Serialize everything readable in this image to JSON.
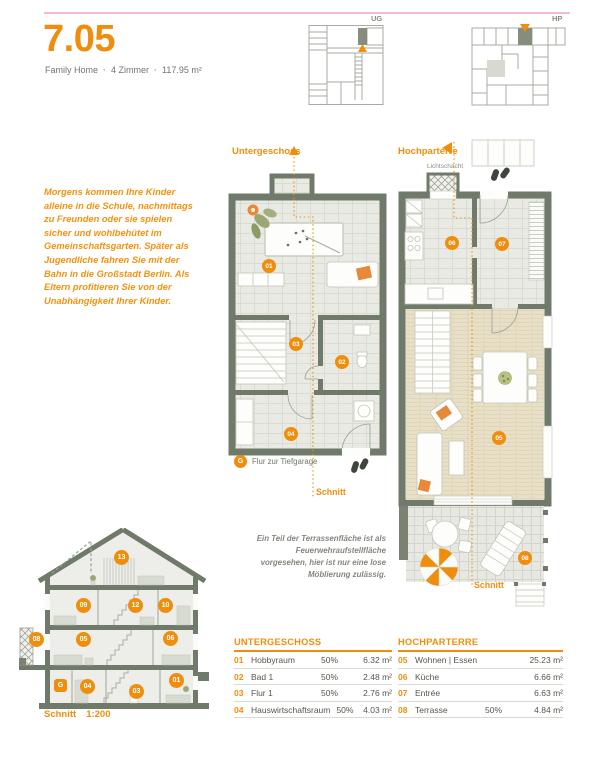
{
  "colors": {
    "accent_orange": "#ef8e0d",
    "wall_green_gray": "#6f7a6a",
    "pink_rule": "#f7b9d2",
    "cushion_orange": "#e8883a"
  },
  "header": {
    "title": "7.05",
    "subtitle": {
      "type": "Family Home",
      "rooms": "4 Zimmer",
      "area": "117.95 m²",
      "separator": "·"
    }
  },
  "key_plans": {
    "ug_label": "UG",
    "hp_label": "HP"
  },
  "intro_text": "Morgens kommen Ihre Kinder alleine in die Schule, nachmittags zu Freunden oder sie spielen sicher und wohlbehütet im Gemeinschaftsgarten. Später als Jugendliche fahren Sie mit der Bahn in die Großstadt Berlin. Als Eltern profitieren Sie von der Unabhängigkeit Ihrer Kinder.",
  "plan_ug": {
    "label": "Untergeschoss",
    "section_label": "Schnitt",
    "markers": {
      "m01": "01",
      "m02": "02",
      "m03": "03",
      "m04": "04"
    },
    "footnote": {
      "marker": "G",
      "text": "Flur zur Tiefgarage"
    }
  },
  "plan_hp": {
    "label": "Hochparterre",
    "lichtschacht": "Lichtschacht",
    "section_label": "Schnitt",
    "markers": {
      "m05": "05",
      "m06": "06",
      "m07": "07",
      "m08": "08"
    }
  },
  "terrace_note": "Ein Teil der Terrassenfläche ist als Feuerwehraufstellfläche vorgesehen, hier ist nur eine lose Möblierung zulässig.",
  "section_view": {
    "caption_label": "Schnitt",
    "caption_scale": "1:200",
    "markers": {
      "m13": "13",
      "m09": "09",
      "m12": "12",
      "m10": "10",
      "m08": "08",
      "m05": "05",
      "m06": "06",
      "mG": "G",
      "m04": "04",
      "m03": "03",
      "m01": "01"
    }
  },
  "table_ug": {
    "title": "UNTERGESCHOSS",
    "rows": [
      {
        "no": "01",
        "name": "Hobbyraum",
        "share": "50%",
        "area": "6.32 m²"
      },
      {
        "no": "02",
        "name": "Bad 1",
        "share": "50%",
        "area": "2.48 m²"
      },
      {
        "no": "03",
        "name": "Flur 1",
        "share": "50%",
        "area": "2.76 m²"
      },
      {
        "no": "04",
        "name": "Hauswirtschaftsraum",
        "share": "50%",
        "area": "4.03 m²"
      }
    ]
  },
  "table_hp": {
    "title": "HOCHPARTERRE",
    "rows": [
      {
        "no": "05",
        "name": "Wohnen | Essen",
        "share": "",
        "area": "25.23 m²"
      },
      {
        "no": "06",
        "name": "Küche",
        "share": "",
        "area": "6.66 m²"
      },
      {
        "no": "07",
        "name": "Entrée",
        "share": "",
        "area": "6.63 m²"
      },
      {
        "no": "08",
        "name": "Terrasse",
        "share": "50%",
        "area": "4.84 m²"
      }
    ]
  }
}
